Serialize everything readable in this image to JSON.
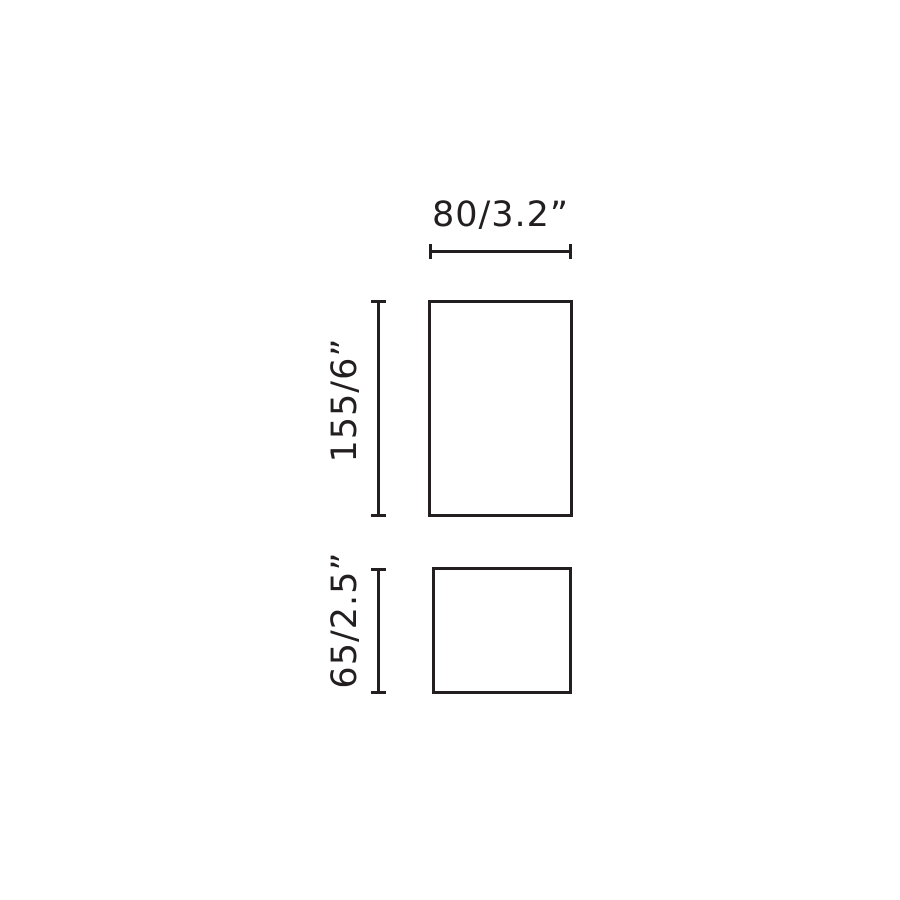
{
  "diagram": {
    "kind": "product-dimension-drawing",
    "background_color": "#ffffff",
    "stroke_color": "#231f20",
    "dimensions": {
      "width": {
        "label": "80/3.2”"
      },
      "upper_height": {
        "label": "155/6”"
      },
      "lower_height": {
        "label": "65/2.5”"
      }
    }
  }
}
